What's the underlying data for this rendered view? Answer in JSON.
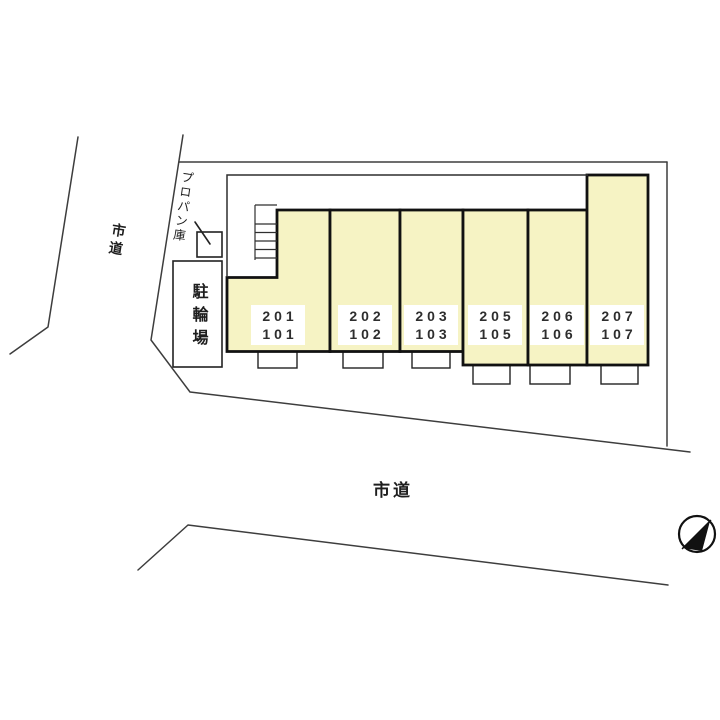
{
  "labels": {
    "road_left": "市道",
    "road_bottom": "市道",
    "propane_storage": "プロパン庫",
    "bicycle_parking": "駐輪場"
  },
  "building": {
    "units": [
      {
        "upper": "201",
        "lower": "101"
      },
      {
        "upper": "202",
        "lower": "102"
      },
      {
        "upper": "203",
        "lower": "103"
      },
      {
        "upper": "205",
        "lower": "105"
      },
      {
        "upper": "206",
        "lower": "106"
      },
      {
        "upper": "207",
        "lower": "107"
      }
    ]
  },
  "colors": {
    "unit_fill": "#f6f3c4",
    "wall_outline": "#111111",
    "site_boundary": "#3d3d3d"
  },
  "icons": {
    "north_arrow": "north-arrow-icon"
  }
}
